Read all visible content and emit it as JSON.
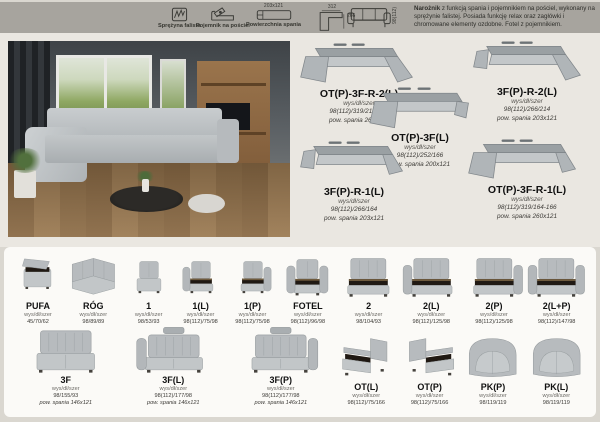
{
  "legend": {
    "items": [
      {
        "icon": "wavy-spring-icon",
        "label": "Sprężyna falista"
      },
      {
        "icon": "bedding-storage-icon",
        "label": "Pojemnik na pościel"
      },
      {
        "icon": "sleeping-surface-icon",
        "label": "Powierzchnia spania",
        "dim": "203x121"
      },
      {
        "icon": "corner-dimensions-icon",
        "width": "312",
        "depth": "266"
      }
    ],
    "sofa_height": "98(112)",
    "description_lead": "Narożnik",
    "description_rest": " z funkcją spania i pojemnikiem na pościel, wykonany na sprężynie falistej. Posiada funkcję relax oraz zagłówki i chromowane elementy ozdobne. Fotel z pojemnikiem."
  },
  "configurations": [
    {
      "name": "OT(P)-3F-R-2(L)",
      "size_label": "wys/dł/szer",
      "dims": "98(112)/319/214-166",
      "sleep": "pow. spania 260x121",
      "shape": "chaise-left-corner-right-long"
    },
    {
      "name": "3F(P)-R-2(L)",
      "size_label": "wys/dł/szer",
      "dims": "98(112)/266/214",
      "sleep": "pow. spania 203x121",
      "shape": "arm-left-corner-right-long"
    },
    {
      "name": "OT(P)-3F(L)",
      "size_label": "wys/dł/szer",
      "dims": "98(112)/252/166",
      "sleep": "pow. spania 200x121",
      "shape": "chaise-left-straight"
    },
    {
      "name": "3F(P)-R-1(L)",
      "size_label": "wys/dł/szer",
      "dims": "98(112)/266/164",
      "sleep": "pow. spania 203x121",
      "shape": "arm-left-corner-right-short"
    },
    {
      "name": "OT(P)-3F-R-1(L)",
      "size_label": "wys/dł/szer",
      "dims": "98(112)/319/164-166",
      "sleep": "pow. spania 260x121",
      "shape": "chaise-left-corner-right-short"
    }
  ],
  "modules_row1": [
    {
      "name": "PUFA",
      "size_label": "wys/dł/szer",
      "dims": "45/70/62",
      "shape": "pouf-open"
    },
    {
      "name": "RÓG",
      "size_label": "wys/dł/szer",
      "dims": "98/89/89",
      "shape": "corner"
    },
    {
      "name": "1",
      "size_label": "wys/dł/szer",
      "dims": "98/53/93",
      "shape": "seat1"
    },
    {
      "name": "1(L)",
      "size_label": "wys/dł/szer",
      "dims": "98(112)/75/98",
      "shape": "seat1-armL-open"
    },
    {
      "name": "1(P)",
      "size_label": "wys/dł/szer",
      "dims": "98(112)/75/98",
      "shape": "seat1-armR-open"
    },
    {
      "name": "FOTEL",
      "size_label": "wys/dł/szer",
      "dims": "98(112)/96/98",
      "shape": "armchair-open"
    },
    {
      "name": "2",
      "size_label": "wys/dł/szer",
      "dims": "98/104/93",
      "shape": "seat2-open"
    },
    {
      "name": "2(L)",
      "size_label": "wys/dł/szer",
      "dims": "98(112)/125/98",
      "shape": "seat2-armL-open"
    },
    {
      "name": "2(P)",
      "size_label": "wys/dł/szer",
      "dims": "98(112)/125/98",
      "shape": "seat2-armR-open"
    },
    {
      "name": "2(L+P)",
      "size_label": "wys/dł/szer",
      "dims": "98(112)/147/98",
      "shape": "seat2-armLR-open"
    }
  ],
  "modules_row2": [
    {
      "name": "3F",
      "size_label": "wys/dł/szer",
      "dims": "98/155/93",
      "sleep": "pow. spania 146x121",
      "shape": "seat3"
    },
    {
      "name": "3F(L)",
      "size_label": "wys/dł/szer",
      "dims": "98(112)/177/98",
      "sleep": "pow. spania 146x121",
      "shape": "seat3-armL-head"
    },
    {
      "name": "3F(P)",
      "size_label": "wys/dł/szer",
      "dims": "98(112)/177/98",
      "sleep": "pow. spania 146x121",
      "shape": "seat3-armR-head"
    },
    {
      "name": "OT(L)",
      "size_label": "wys/dł/szer",
      "dims": "98(112)/75/166",
      "shape": "chaiseL"
    },
    {
      "name": "OT(P)",
      "size_label": "wys/dł/szer",
      "dims": "98(112)/75/166",
      "shape": "chaiseR"
    },
    {
      "name": "PK(P)",
      "size_label": "wys/dł/szer",
      "dims": "98/119/119",
      "shape": "roundR"
    },
    {
      "name": "PK(L)",
      "size_label": "wys/dł/szer",
      "dims": "98/119/119",
      "shape": "roundL"
    }
  ]
}
